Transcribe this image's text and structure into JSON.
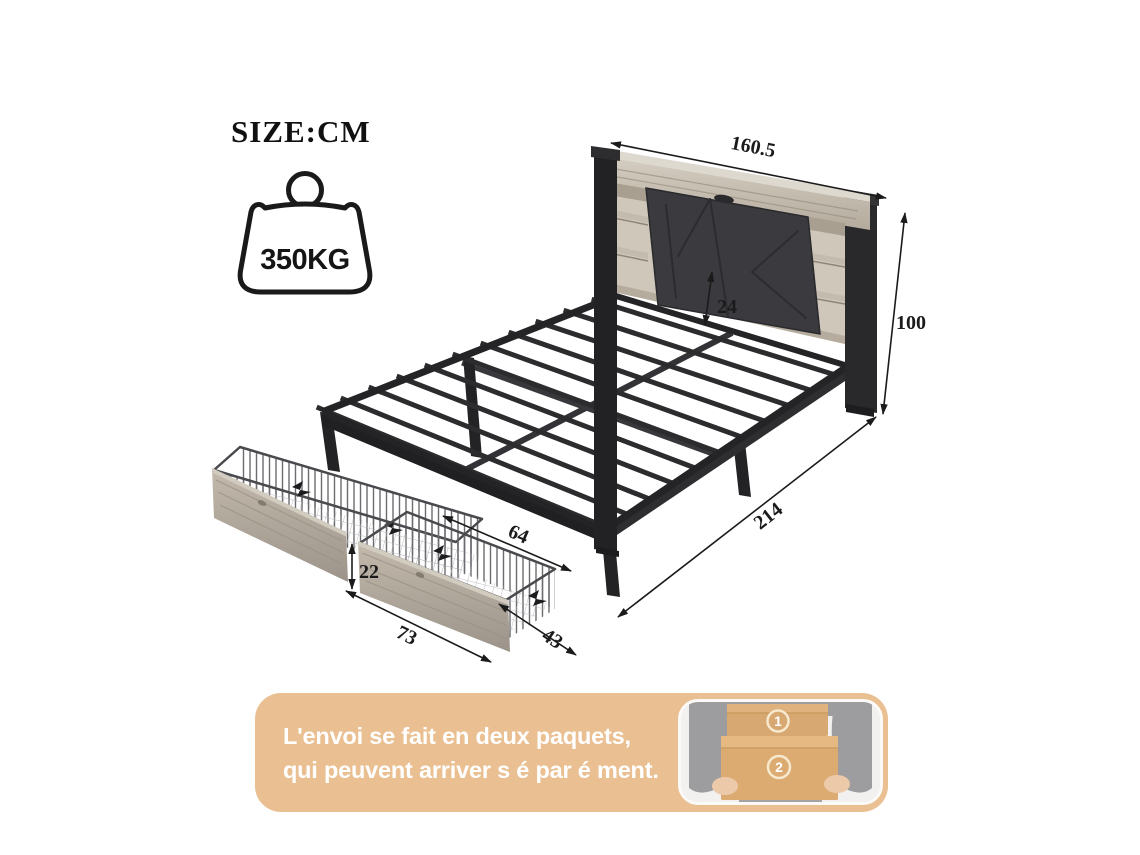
{
  "size_unit_label": "SIZE:CM",
  "weight_capacity": "350KG",
  "dimensions": {
    "headboard_width": "160.5",
    "total_height": "100",
    "headboard_clearance": "24",
    "total_length": "214",
    "drawer_top_length": "64",
    "drawer_height": "22",
    "drawer_front_length": "73",
    "drawer_depth": "43"
  },
  "shipping_banner": {
    "line1": "L'envoi se fait en deux paquets,",
    "line2": "qui peuvent arriver s é par é ment.",
    "package1_label": "1",
    "package2_label": "2"
  },
  "colors": {
    "banner_bg": "#eac092",
    "metal": "#2a2a2d",
    "wood": "#c8c0b3",
    "drawer_wood": "#b2a99c",
    "upholstery": "#3b3b3f",
    "carton_box": "#d8a872",
    "dimension_ink": "#1b1b1b"
  }
}
